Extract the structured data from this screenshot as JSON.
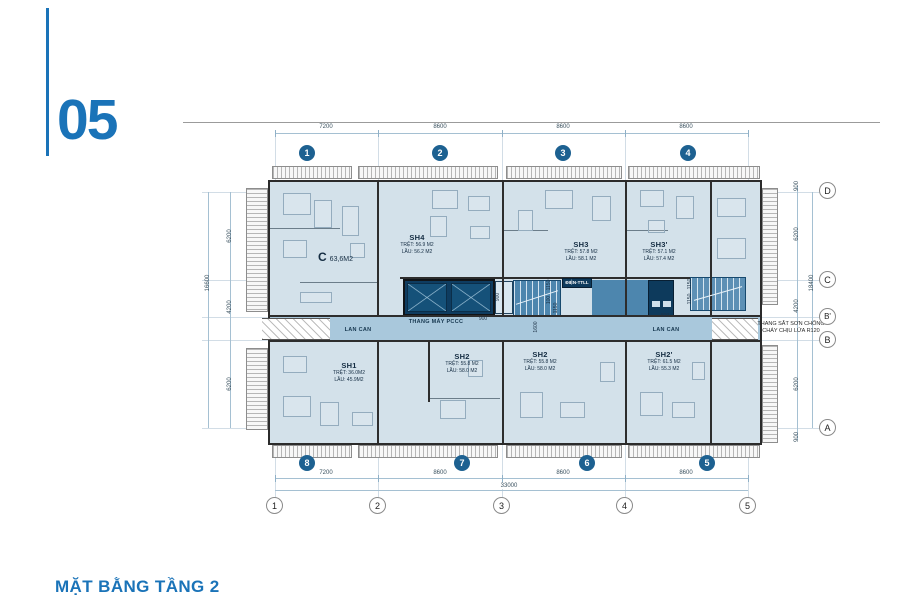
{
  "page": {
    "number": "05",
    "title": "MẶT BẰNG TẦNG 2"
  },
  "plan": {
    "grid": {
      "top_bubbles": [
        "1",
        "2",
        "3",
        "4"
      ],
      "bottom_bubbles": [
        "8",
        "7",
        "6",
        "5"
      ],
      "bottom_axis_bubbles": [
        "1",
        "2",
        "3",
        "4",
        "5"
      ],
      "right_letters": [
        "D",
        "C",
        "B'",
        "B",
        "A"
      ]
    },
    "dims": {
      "top": [
        "7200",
        "8600",
        "8600",
        "8600"
      ],
      "bottom": [
        "7200",
        "8600",
        "8600",
        "8600"
      ],
      "bottom_total": "33000",
      "left": [
        "6200",
        "4200",
        "6200"
      ],
      "left_total": "16600",
      "right": [
        "900",
        "6200",
        "4200",
        "6200",
        "900"
      ],
      "right_total": "18400",
      "core": [
        "900",
        "900",
        "1150",
        "100",
        "1150",
        "1600",
        "1150",
        "1150",
        "800"
      ]
    },
    "units": {
      "c": {
        "name": "C",
        "area": "63,6M2"
      },
      "sh4": {
        "name": "SH4",
        "tret": "TRỆT: 56.9 M2",
        "lau": "LẦU: 56.2 M2"
      },
      "sh3": {
        "name": "SH3",
        "tret": "TRỆT: 57.8 M2",
        "lau": "LẦU: 58.1 M2"
      },
      "sh3p": {
        "name": "SH3'",
        "tret": "TRỆT: 57.1 M2",
        "lau": "LẦU: 57.4 M2"
      },
      "sh1": {
        "name": "SH1",
        "tret": "TRỆT: 36.0M2",
        "lau": "LẦU: 45.9M2"
      },
      "sh2a": {
        "name": "SH2",
        "tret": "TRỆT: 55.8 M2",
        "lau": "LẦU: 58.0 M2"
      },
      "sh2b": {
        "name": "SH2",
        "tret": "TRỆT: 55.8 M2",
        "lau": "LẦU: 58.0 M2"
      },
      "sh2p": {
        "name": "SH2'",
        "tret": "TRỆT: 61.5 M2",
        "lau": "LẦU: 55.3 M2"
      }
    },
    "corridor": {
      "lan_can_left": "LAN CAN",
      "lan_can_right": "LAN CAN",
      "fire_elevator": "THANG MÁY PCCC",
      "utility": "ĐIỆN-TTLL",
      "ladder_note_1": "THANG SẮT SƠN CHỐNG",
      "ladder_note_2": "CHÁY CHỊU LỬA R120"
    },
    "colors": {
      "accent": "#1a73b8",
      "bubble_fill": "#1d6191",
      "floor": "#d3e1ea",
      "corridor": "#a9c8dc",
      "core": "#4d86ae",
      "shaft": "#155179",
      "wall": "#2d2d2d"
    }
  }
}
